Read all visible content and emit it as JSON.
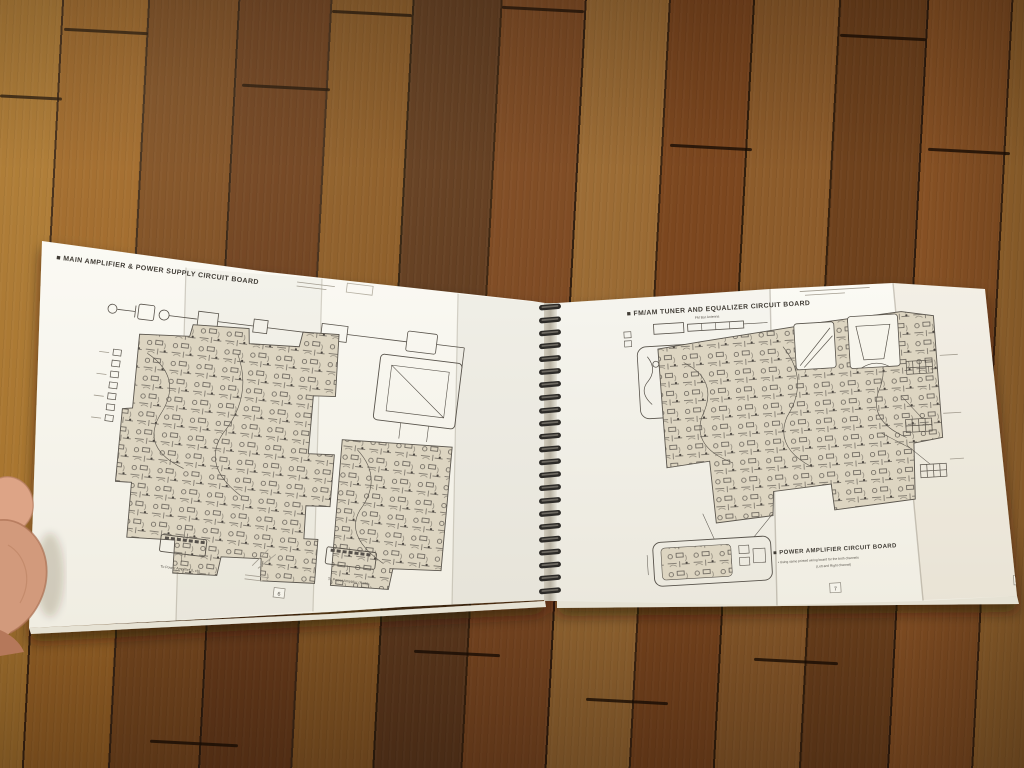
{
  "manual": {
    "left_page": {
      "title": "■ MAIN AMPLIFIER & POWER SUPPLY CIRCUIT BOARD",
      "connector_label_left": "To Power Amplifier (L ch)",
      "connector_label_right": "To Power Amplifier (R ch)",
      "page_number_left": "5",
      "page_number_right": "6"
    },
    "right_page": {
      "title": "■ FM/AM TUNER AND EQUALIZER CIRCUIT BOARD",
      "antenna_label": "FM Bar Antenna",
      "section2_title": "■ POWER AMPLIFIER CIRCUIT BOARD",
      "section2_note_line1": "• Using same printed wiring board for the both channels",
      "section2_note_line2": "(Left and Right channel)",
      "page_number_left": "7",
      "page_number_right": "8"
    },
    "spiral_binding": {
      "coil_count": 23
    }
  },
  "colors": {
    "paper": "#faf8f1",
    "paper_shaded": "#efece2",
    "ink": "#57524a",
    "pcb_tint": "#ddd5c1",
    "spiral_wire": "#2d2b28",
    "wood_light": "#a8752f",
    "wood_medium": "#7a4a20",
    "wood_dark": "#5f3a1e",
    "skin": "#d9a184"
  }
}
